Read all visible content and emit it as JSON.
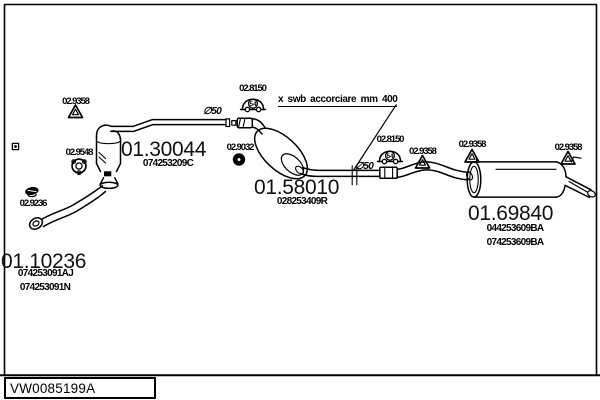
{
  "frame": {
    "sheet_code": "VW0085199A"
  },
  "annotation": {
    "shorten_note": "x swb accorciare mm 400"
  },
  "diameters": {
    "d1": "∅50",
    "d2": "∅50"
  },
  "main_parts": {
    "front_pipe": {
      "number": "01.10236",
      "code1": "074253091AJ",
      "code2": "074253091N"
    },
    "middle_pipe": {
      "number": "01.30044",
      "code1": "074253209C"
    },
    "centre_muffler": {
      "number": "01.58010",
      "code1": "028253409R"
    },
    "rear_muffler": {
      "number": "01.69840",
      "code1": "044253609BA",
      "code2": "074253609BA"
    }
  },
  "small_parts": {
    "hanger_left": "02.9358",
    "gasket": "02.9548",
    "clamp": "02.9236",
    "mount_a": "02.8150",
    "ring": "02.9032",
    "mount_b": "02.8150",
    "hanger_mid": "02.9358",
    "hanger_rear_left": "02.9358",
    "hanger_rear_right": "02.9358",
    "mount_mark": "54"
  }
}
